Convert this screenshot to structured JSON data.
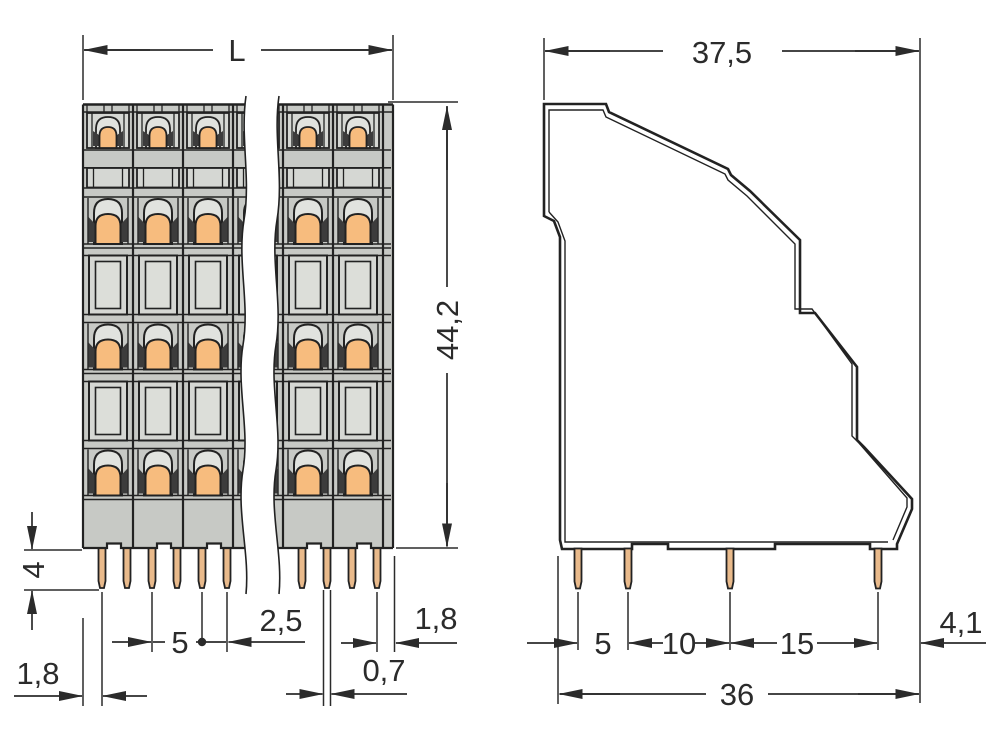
{
  "drawing": {
    "kind": "technical dimensional drawing",
    "subject": "multi-level PCB terminal block, front view with break lines and side profile view",
    "units": "mm",
    "front_view": {
      "visible_poles": 6,
      "clamp_levels": 4,
      "pins_per_pole": 2,
      "has_break_lines": true
    },
    "side_view": {
      "pins": 4,
      "stepped_profile": true
    }
  },
  "labels": {
    "front_length": "L",
    "front_height": "44,2",
    "front_pin_length": "4",
    "front_edge_to_first_pin": "1,8",
    "front_pole_pitch": "5",
    "front_pin_spacing": "2,5",
    "front_pin_width": "0,7",
    "front_last_pin_to_edge": "1,8",
    "side_depth": "37,5",
    "side_pin1_pin2": "5",
    "side_pin2_pin3": "10",
    "side_pin3_pin4": "15",
    "side_pin4_to_edge": "4,1",
    "side_footprint": "36"
  },
  "dimensions": [
    {
      "view": "front",
      "label": "L",
      "orientation": "horizontal",
      "meaning": "overall length (broken view)"
    },
    {
      "view": "front",
      "label": "44,2",
      "orientation": "vertical",
      "meaning": "housing height"
    },
    {
      "view": "front",
      "label": "4",
      "orientation": "vertical",
      "meaning": "solder pin length"
    },
    {
      "view": "front",
      "label": "1,8",
      "orientation": "horizontal",
      "meaning": "left edge to first pin"
    },
    {
      "view": "front",
      "label": "5",
      "orientation": "horizontal",
      "meaning": "pole pitch"
    },
    {
      "view": "front",
      "label": "2,5",
      "orientation": "horizontal",
      "meaning": "pin spacing within pole"
    },
    {
      "view": "front",
      "label": "0,7",
      "orientation": "horizontal",
      "meaning": "pin width"
    },
    {
      "view": "front",
      "label": "1,8",
      "orientation": "horizontal",
      "meaning": "last pin to right edge"
    },
    {
      "view": "side",
      "label": "37,5",
      "orientation": "horizontal",
      "meaning": "overall depth"
    },
    {
      "view": "side",
      "label": "5",
      "orientation": "horizontal",
      "meaning": "pin row 1 to 2"
    },
    {
      "view": "side",
      "label": "10",
      "orientation": "horizontal",
      "meaning": "pin row 2 to 3"
    },
    {
      "view": "side",
      "label": "15",
      "orientation": "horizontal",
      "meaning": "pin row 3 to 4"
    },
    {
      "view": "side",
      "label": "4,1",
      "orientation": "horizontal",
      "meaning": "pin row 4 to rear edge"
    },
    {
      "view": "side",
      "label": "36",
      "orientation": "horizontal",
      "meaning": "footprint depth"
    }
  ],
  "colors": {
    "background": "#ffffff",
    "line": "#2b2b2b",
    "outline": "#222222",
    "body_gray": "#c7c9c5",
    "panel_gray": "#d5d7d3",
    "pane_gray": "#dcded9",
    "arch_gray": "#e1e3df",
    "wing_dark": "#3c3c3c",
    "lever_orange": "#f7bc7e",
    "pin_tan": "#e9ba8b"
  }
}
